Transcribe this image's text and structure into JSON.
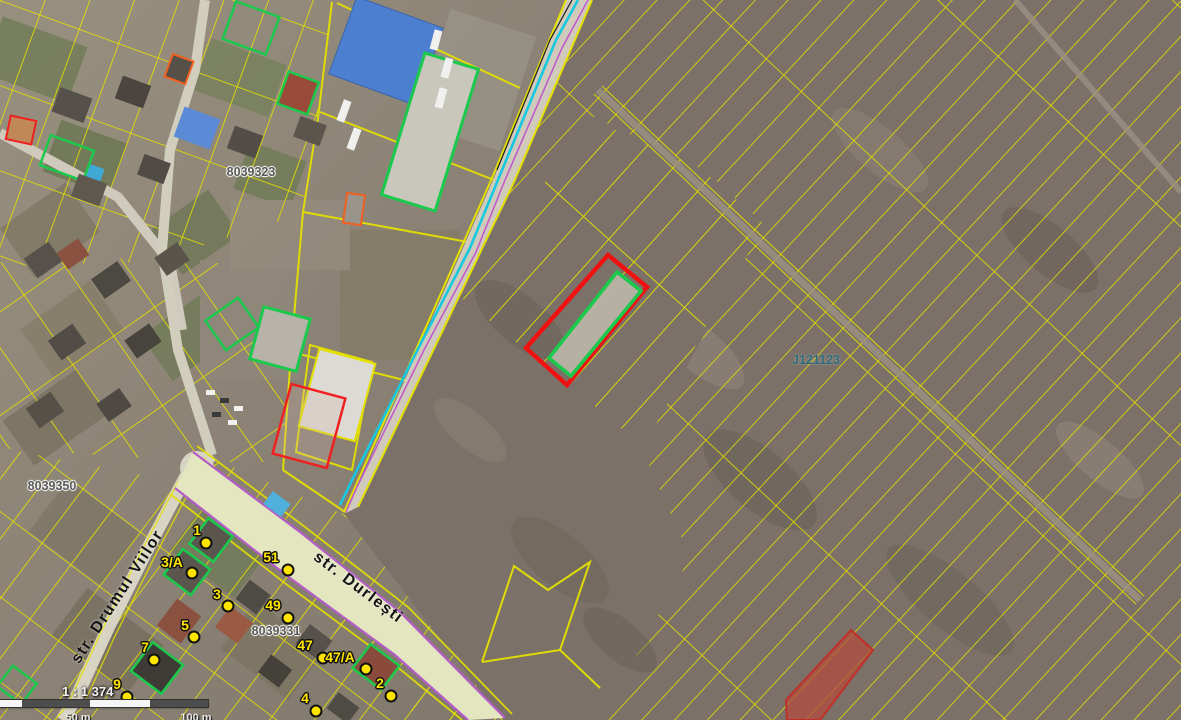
{
  "map": {
    "type": "cadastral-satellite-map",
    "street_labels": [
      {
        "id": "drumul-viilor",
        "text": "str. Drumul Viilor",
        "x": 118,
        "y": 597,
        "rotation": -57
      },
      {
        "id": "durlesti",
        "text": "str. Durlești",
        "x": 358,
        "y": 588,
        "rotation": 37
      }
    ],
    "parcel_labels": [
      {
        "text": "8039323",
        "x": 251,
        "y": 172
      },
      {
        "text": "8039350",
        "x": 52,
        "y": 486
      },
      {
        "text": "8039331",
        "x": 276,
        "y": 631
      }
    ],
    "zone_label": {
      "text": "J121123",
      "x": 816,
      "y": 360
    },
    "house_markers": [
      {
        "text": "1",
        "lx": 197,
        "ly": 530,
        "dx": 206,
        "dy": 543
      },
      {
        "text": "3/A",
        "lx": 172,
        "ly": 562,
        "dx": 192,
        "dy": 573
      },
      {
        "text": "51",
        "lx": 271,
        "ly": 557,
        "dx": 288,
        "dy": 570
      },
      {
        "text": "3",
        "lx": 217,
        "ly": 594,
        "dx": 228,
        "dy": 606
      },
      {
        "text": "49",
        "lx": 273,
        "ly": 605,
        "dx": 288,
        "dy": 618
      },
      {
        "text": "5",
        "lx": 185,
        "ly": 625,
        "dx": 194,
        "dy": 637
      },
      {
        "text": "7",
        "lx": 145,
        "ly": 647,
        "dx": 154,
        "dy": 660
      },
      {
        "text": "9",
        "lx": 117,
        "ly": 684,
        "dx": 127,
        "dy": 697
      },
      {
        "text": "47",
        "lx": 305,
        "ly": 645,
        "dx": 323,
        "dy": 658
      },
      {
        "text": "47/A",
        "lx": 340,
        "ly": 657,
        "dx": 366,
        "dy": 669
      },
      {
        "text": "2",
        "lx": 380,
        "ly": 683,
        "dx": 391,
        "dy": 696
      },
      {
        "text": "4",
        "lx": 305,
        "ly": 698,
        "dx": 316,
        "dy": 711
      }
    ],
    "scale": {
      "ratio_text": "1 : 1 374",
      "tick_labels": [
        "50 m",
        "100 m"
      ],
      "tick_positions_px": [
        78,
        196
      ]
    },
    "colors": {
      "parcel_line": "#e4e000",
      "selection_outline": "#f01212",
      "selected_inner_outline": "#1bc94c",
      "building_outline_green": "#1bc94c",
      "building_outline_red": "#f03018",
      "road_boundary_purple": "#b45cc8",
      "utility_line_cyan": "#16c8e0",
      "field_ground": "#7b7168",
      "road_fill": "#e4e6c0",
      "highlight_parcel_fill": "#b44a3c",
      "marker_yellow": "#ffe400"
    }
  }
}
